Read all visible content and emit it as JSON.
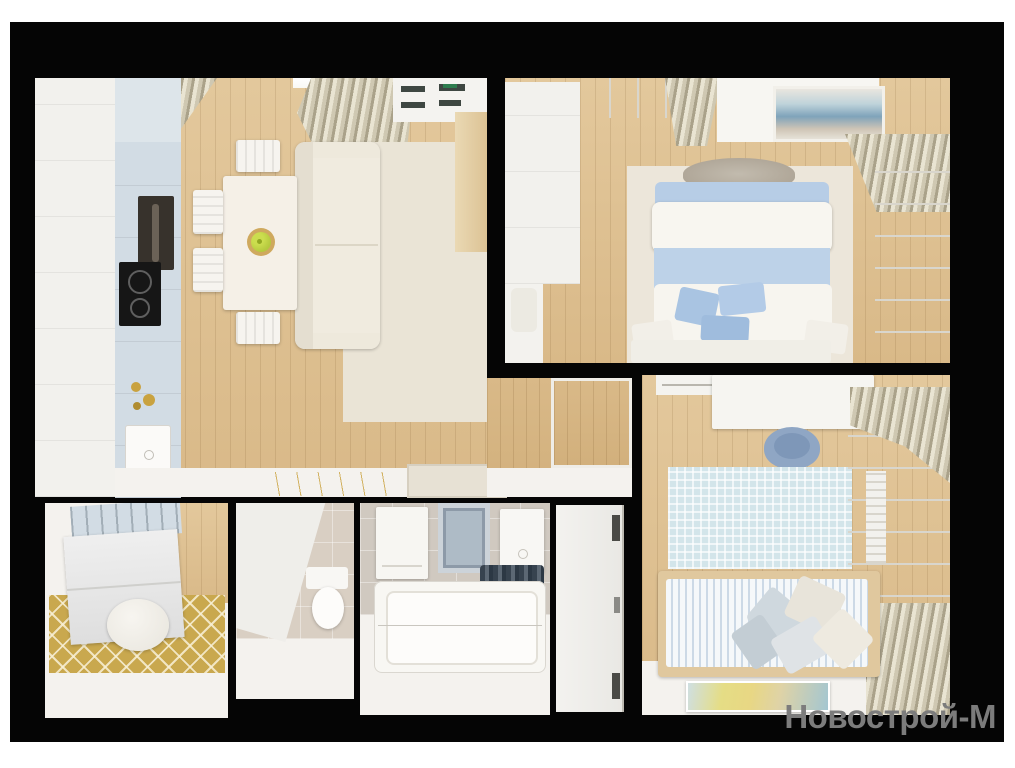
{
  "watermark": {
    "text": "Новострой-М"
  },
  "colors": {
    "page_bg": "#ffffff",
    "wall_black": "#050505",
    "floor_wood": "#d9b988",
    "floor_wood_light": "#e3c89c",
    "floor_wood_dark": "#d2b07c",
    "floor_white": "#f4f2ee",
    "cabinet_white": "#f2f1ed",
    "cabinet_blue": "#d2dce4",
    "cabinet_blue_light": "#dde5ea",
    "oven_dark": "#37322c",
    "cooktop_black": "#161616",
    "sofa_cream": "#f0ebdf",
    "rug_living": "#eae4d6",
    "rug_bedroom": "#ece6da",
    "bed_white": "#f8f6f0",
    "bed_blue": "#bdd2e8",
    "pillow_blue": "#a9c4e2",
    "curtain_light": "#e9e4d2",
    "curtain_mid": "#cfc8b2",
    "curtain_dark": "#aaa28a",
    "window_white": "#f9f8f4",
    "wood_furniture": "#e0c89e",
    "rug_gold": "#c9a84e",
    "rug_kids": "#d3e5ea",
    "tile_beige": "#d9cfc3",
    "tile_gray": "#d0c9c0",
    "towel_navy": "#37434f",
    "chair_blue": "#8fa6c4",
    "apple_green": "#b5c93e",
    "gold_accent": "#c9a23f",
    "watermark_gray": "#7c7c7c"
  }
}
